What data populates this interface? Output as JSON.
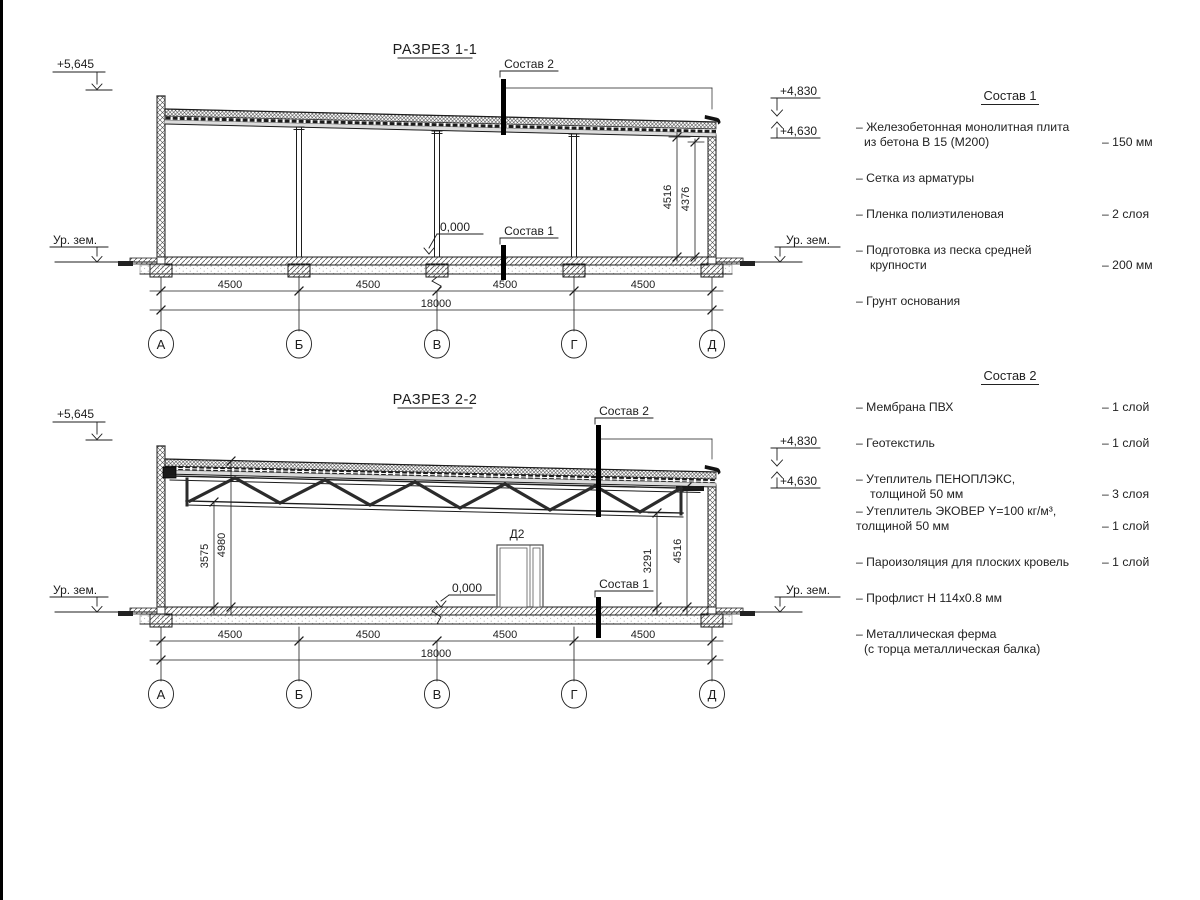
{
  "section1": {
    "title": "РАЗРЕЗ 1-1",
    "callout_roof": "Состав 2",
    "callout_floor": "Состав 1",
    "elev_parapet": "+5,645",
    "elev_roof_top": "+4,830",
    "elev_roof_bottom": "+4,630",
    "ground_left": "Ур. зем.",
    "ground_right": "Ур. зем.",
    "zero_level": "0,000",
    "dim_right_outer": "4516",
    "dim_right_inner": "4376",
    "bays": [
      "4500",
      "4500",
      "4500",
      "4500"
    ],
    "total": "18000",
    "axes": [
      "А",
      "Б",
      "В",
      "Г",
      "Д"
    ]
  },
  "section2": {
    "title": "РАЗРЕЗ 2-2",
    "callout_roof": "Состав 2",
    "callout_floor": "Состав 1",
    "elev_parapet": "+5,645",
    "elev_roof_top": "+4,830",
    "elev_roof_bottom": "+4,630",
    "ground_left": "Ур. зем.",
    "ground_right": "Ур. зем.",
    "zero_level": "0,000",
    "door_label": "Д2",
    "dim_left_inner": "3575",
    "dim_left_outer": "4980",
    "dim_right_inner": "3291",
    "dim_right_outer": "4516",
    "bays": [
      "4500",
      "4500",
      "4500",
      "4500"
    ],
    "total": "18000",
    "axes": [
      "А",
      "Б",
      "В",
      "Г",
      "Д"
    ]
  },
  "composition1": {
    "title": "Состав 1",
    "items": [
      {
        "lines": [
          "– Железобетонная  монолитная плита",
          "из бетона В 15 (М200)"
        ],
        "value": "– 150 мм"
      },
      {
        "lines": [
          "– Сетка из арматуры"
        ],
        "value": ""
      },
      {
        "lines": [
          "– Пленка полиэтиленовая"
        ],
        "value": "– 2 слоя"
      },
      {
        "lines": [
          "– Подготовка из песка средней",
          "крупности"
        ],
        "value": "– 200 мм"
      },
      {
        "lines": [
          "– Грунт основания"
        ],
        "value": ""
      }
    ]
  },
  "composition2": {
    "title": "Состав 2",
    "items": [
      {
        "lines": [
          "– Мембрана ПВХ"
        ],
        "value": "– 1 слой"
      },
      {
        "lines": [
          "– Геотекстиль"
        ],
        "value": "– 1 слой"
      },
      {
        "lines": [
          "– Утеплитель ПЕНОПЛЭКС,",
          "толщиной 50 мм"
        ],
        "value": "– 3 слоя"
      },
      {
        "lines": [
          "– Утеплитель ЭКОВЕР Y=100 кг/м³,",
          "толщиной 50 мм"
        ],
        "value": "– 1 слой"
      },
      {
        "lines": [
          "– Пароизоляция для плоских кровель"
        ],
        "value": "– 1 слой"
      },
      {
        "lines": [
          "– Профлист Н 114х0.8 мм"
        ],
        "value": ""
      },
      {
        "lines": [
          "– Металлическая ферма",
          "(с торца металлическая балка)"
        ],
        "value": ""
      }
    ]
  }
}
